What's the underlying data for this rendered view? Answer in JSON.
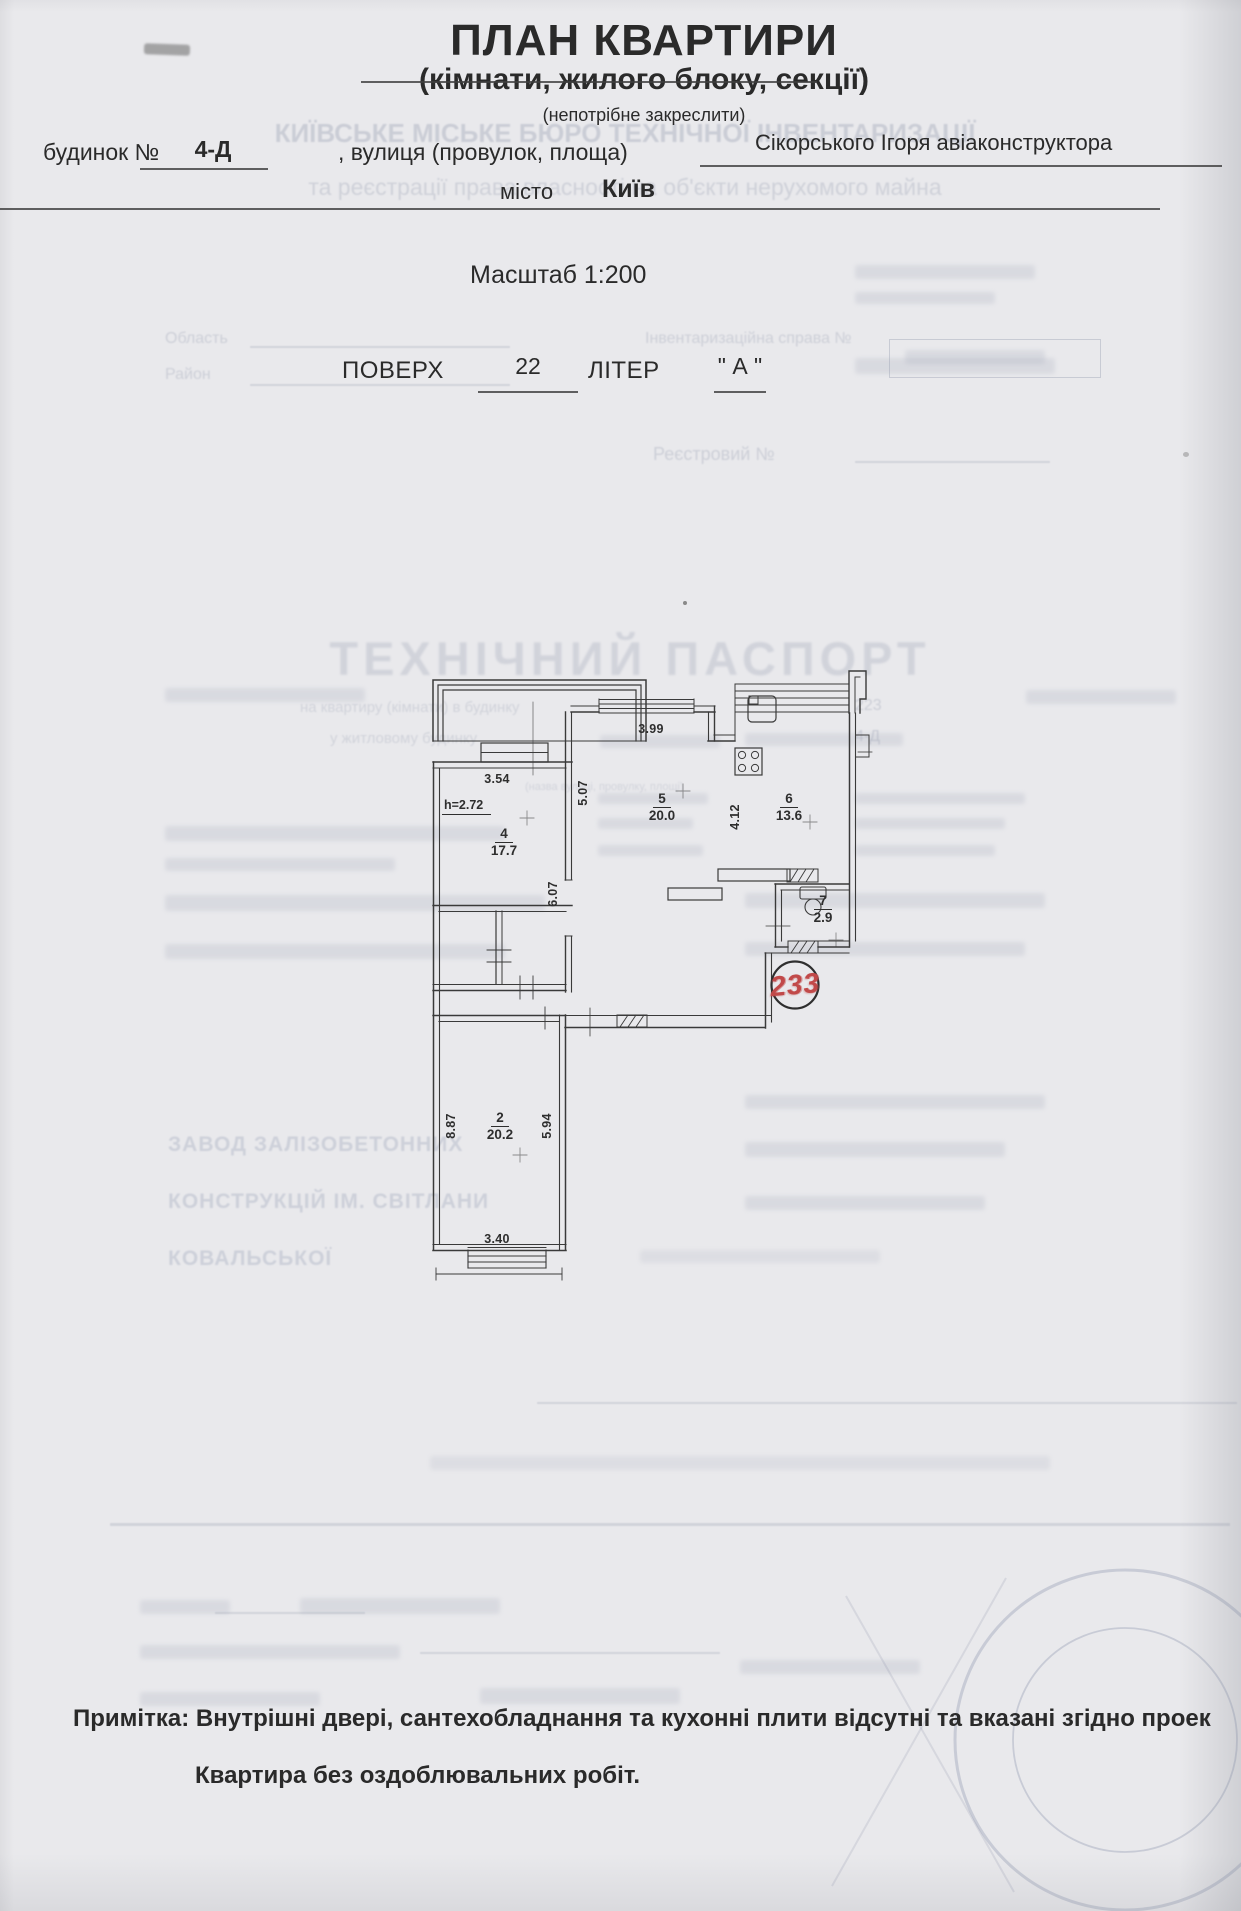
{
  "document": {
    "title": "ПЛАН КВАРТИРИ",
    "subtitle": "(кімнати, жилого блоку, секції)",
    "subtitle_note": "(непотрібне закреслити)",
    "building_label": "будинок №",
    "building_value": "4-Д",
    "street_label": ", вулиця (провулок, площа)",
    "street_value": "Сікорського Ігоря авіаконструктора",
    "city_label": "місто",
    "city_value": "Київ",
    "scale": "Масштаб 1:200",
    "floor_label": "ПОВЕРХ",
    "floor_value": "22",
    "letter_label": "ЛІТЕР",
    "letter_value": "\" А \"",
    "note_label": "Примітка:",
    "note_line1": "Примітка: Внутрішні двері, сантехобладнання та кухонні плити відсутні та вказані згідно проек",
    "note_line2": "Квартира без оздоблювальних робіт."
  },
  "plan": {
    "stamp_number": "233",
    "height_mark": "h=2.72",
    "rooms": [
      {
        "number": "4",
        "area": "17.7"
      },
      {
        "number": "5",
        "area": "20.0"
      },
      {
        "number": "6",
        "area": "13.6"
      },
      {
        "number": "7",
        "area": "2.9"
      },
      {
        "number": "2",
        "area": "20.2"
      }
    ],
    "dimensions": {
      "room4_width": "3.54",
      "room5_width": "3.99",
      "room5_depth": "5.07",
      "hall_depth": "6.07",
      "room6_depth": "4.12",
      "room2_depth": "8.87",
      "room2_inner": "5.94",
      "room2_width": "3.40"
    }
  },
  "ghost": {
    "bureau_line1": "КИЇВСЬКЕ МІСЬКЕ БЮРО ТЕХНІЧНОЇ ІНВЕНТАРИЗАЦІЇ",
    "bureau_line2": "та реєстрації права власності на об'єкти нерухомого майна",
    "oblast": "Область",
    "raion": "Район",
    "inventory_case": "Інвентаризаційна справа №",
    "registry": "Реєстровий №",
    "tech_passport": "ТЕХНІЧНИЙ ПАСПОРТ",
    "apartment_line": "на квартиру (кімнати) в будинку",
    "apartment_no": "223",
    "building_line": "у житловому будинку",
    "building_no": "4-Д",
    "street_footnote": "(назва вулиці, провулку, площі)",
    "company_line1": "ЗАВОД ЗАЛІЗОБЕТОННИХ",
    "company_line2": "КОНСТРУКЦІЙ ІМ. СВІТЛАНИ",
    "company_line3": "КОВАЛЬСЬКОЇ"
  }
}
